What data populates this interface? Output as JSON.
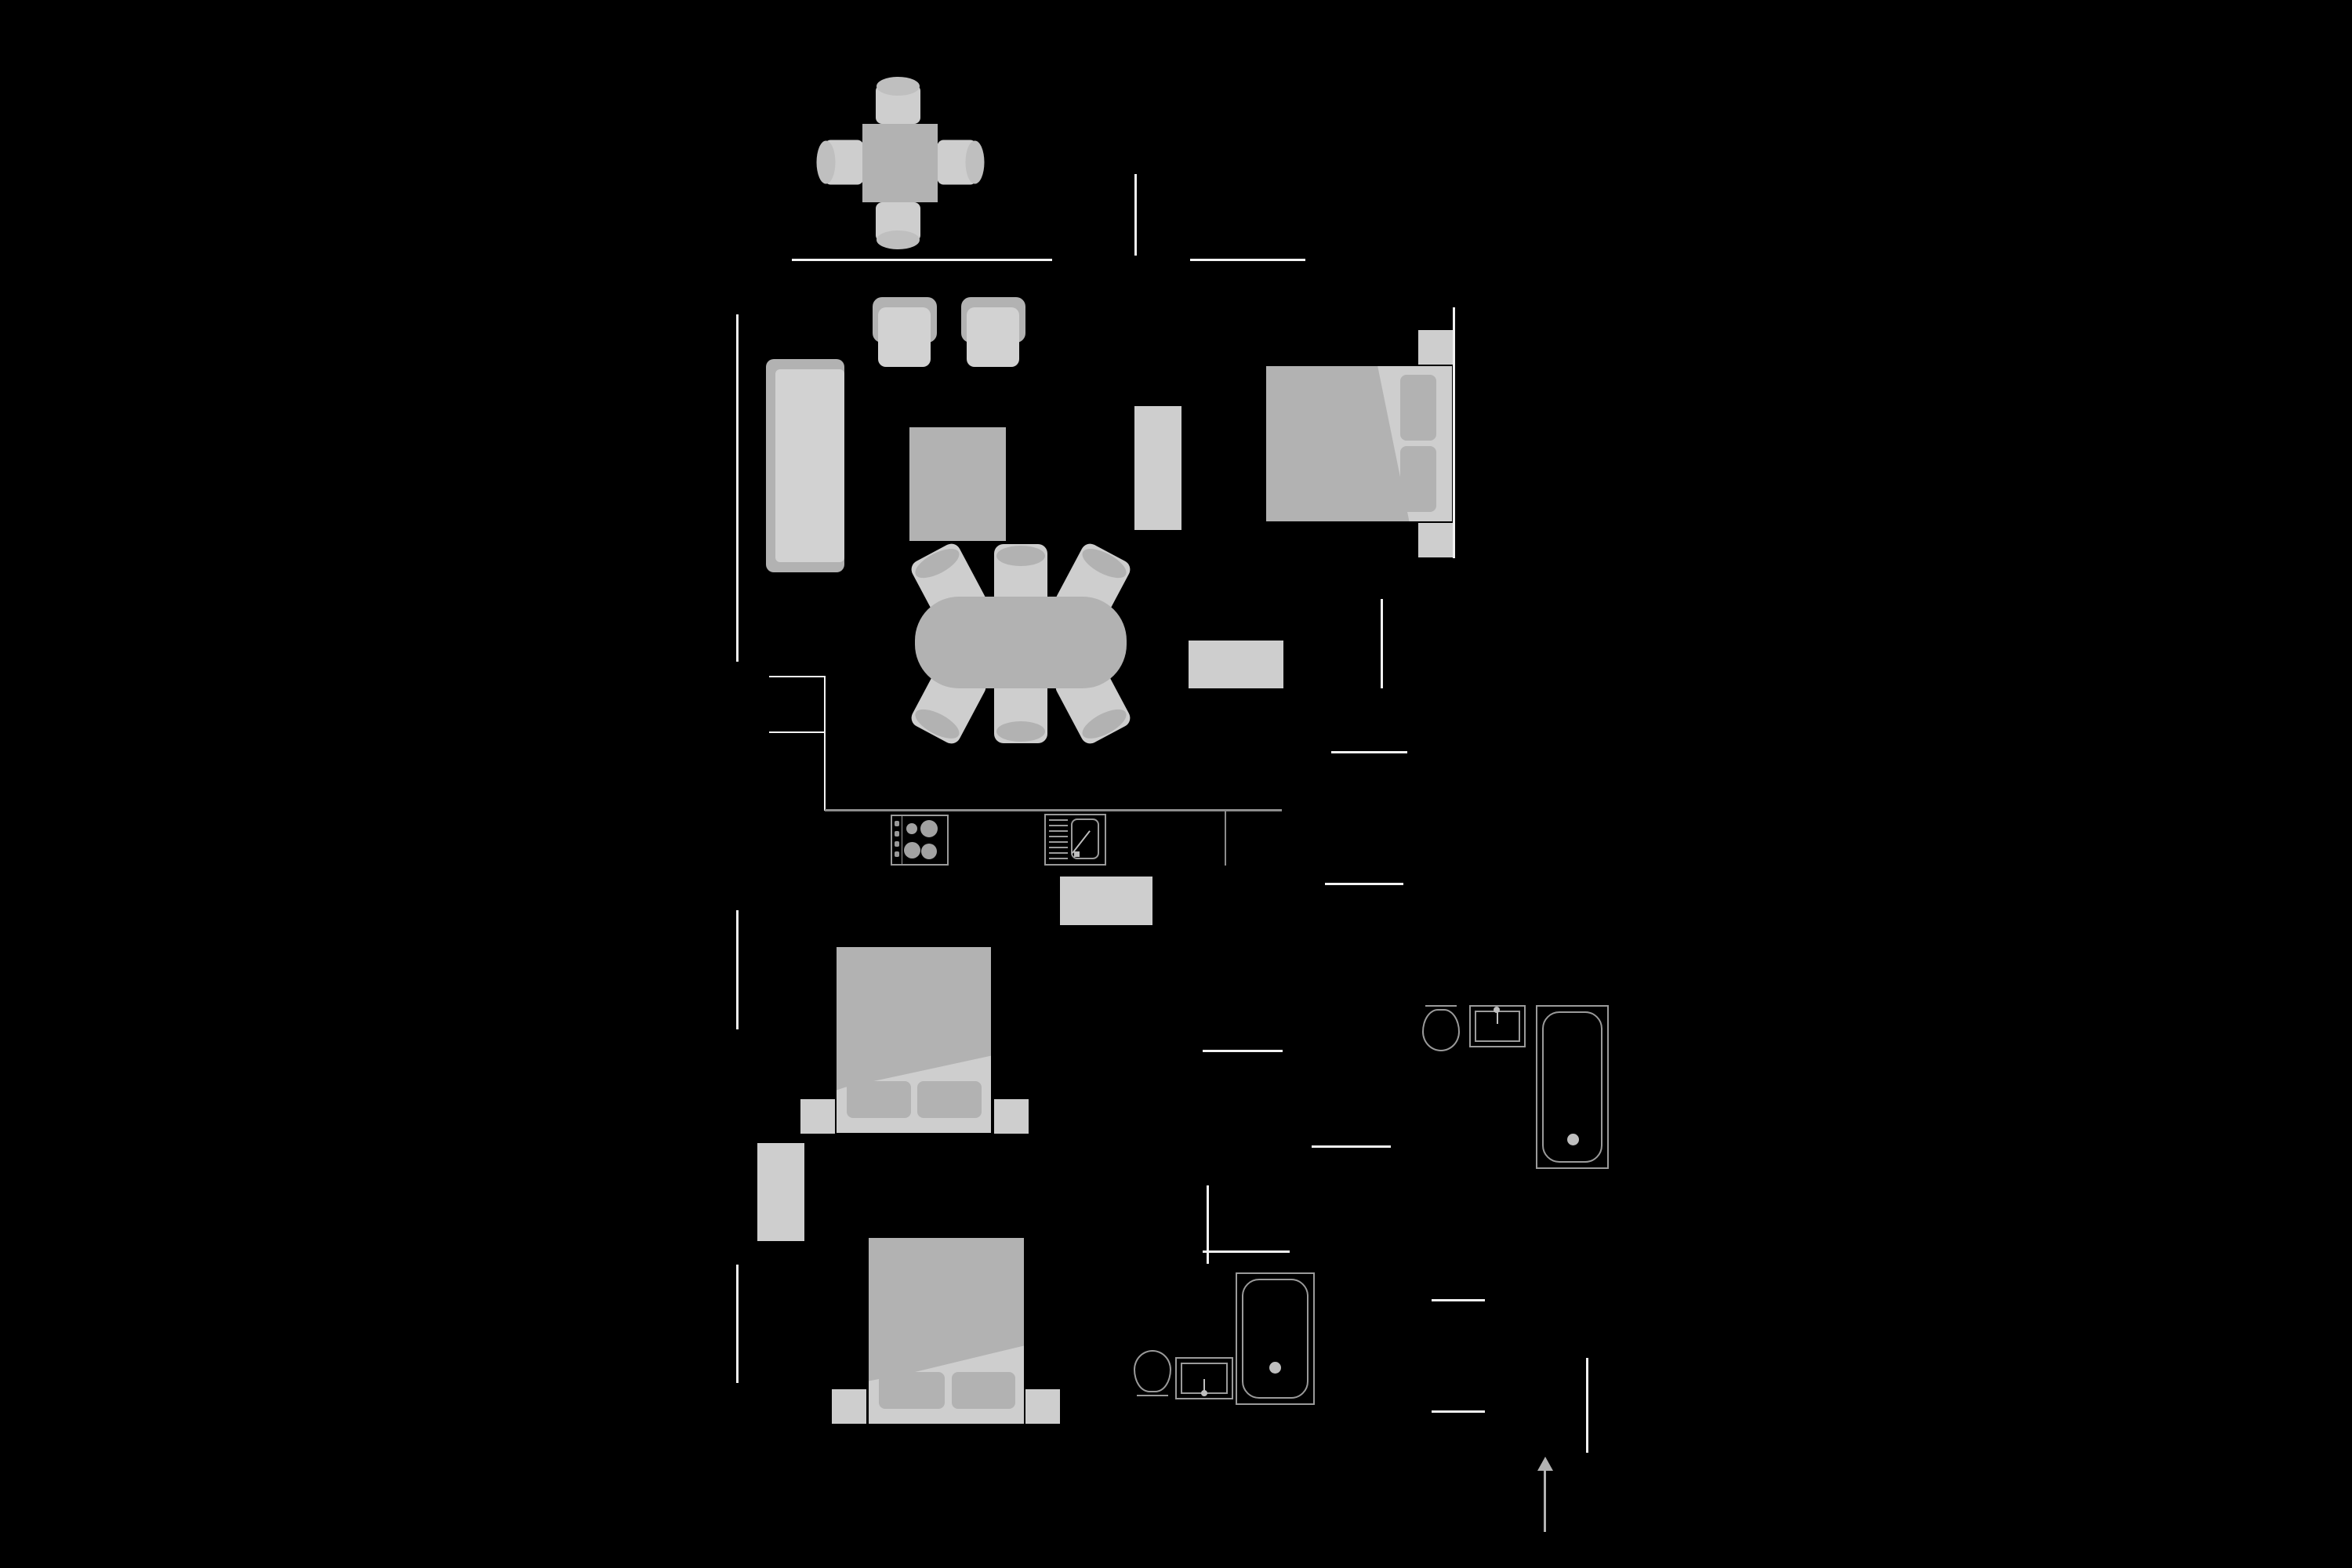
{
  "colors": {
    "background": "#000000",
    "wall": "#f2f2f2",
    "line": "#8c8c8c",
    "outline": "#9a9a9a",
    "flight": "#cecece",
    "fmid": "#b2b2b2",
    "cap": "#bfbfbf",
    "seat": "#d2d2d2",
    "burner": "#a2a2a2",
    "arrow": "#b2b2b2"
  },
  "plan": {
    "type": "apartment-floor-plan",
    "areas": [
      {
        "name": "balcony",
        "furniture": [
          {
            "icon": "bistro-table",
            "count": 1
          },
          {
            "icon": "stool",
            "count": 4
          }
        ]
      },
      {
        "name": "living-room",
        "furniture": [
          {
            "icon": "sofa",
            "count": 1
          },
          {
            "icon": "armchair",
            "count": 2
          },
          {
            "icon": "coffee-table",
            "count": 1
          },
          {
            "icon": "tv-cabinet",
            "count": 1
          }
        ]
      },
      {
        "name": "dining-area",
        "furniture": [
          {
            "icon": "oval-dining-table",
            "count": 1
          },
          {
            "icon": "dining-chair",
            "count": 6
          },
          {
            "icon": "sideboard",
            "count": 1
          }
        ]
      },
      {
        "name": "kitchen",
        "furniture": [
          {
            "icon": "cooktop",
            "count": 1
          },
          {
            "icon": "kitchen-sink",
            "count": 1
          },
          {
            "icon": "kitchen-island",
            "count": 1
          }
        ]
      },
      {
        "name": "bedroom-1",
        "furniture": [
          {
            "icon": "double-bed",
            "count": 1
          },
          {
            "icon": "nightstand",
            "count": 2
          }
        ]
      },
      {
        "name": "bedroom-2",
        "furniture": [
          {
            "icon": "double-bed",
            "count": 1
          },
          {
            "icon": "nightstand",
            "count": 2
          },
          {
            "icon": "wardrobe",
            "count": 1
          }
        ]
      },
      {
        "name": "bedroom-3",
        "furniture": [
          {
            "icon": "double-bed",
            "count": 1
          },
          {
            "icon": "nightstand",
            "count": 2
          }
        ]
      },
      {
        "name": "bathroom-1",
        "furniture": [
          {
            "icon": "toilet",
            "count": 1
          },
          {
            "icon": "washbasin",
            "count": 1
          },
          {
            "icon": "bathtub",
            "count": 1
          }
        ]
      },
      {
        "name": "bathroom-2",
        "furniture": [
          {
            "icon": "toilet",
            "count": 1
          },
          {
            "icon": "washbasin",
            "count": 1
          },
          {
            "icon": "shower-tub",
            "count": 1
          }
        ]
      }
    ],
    "annotations": [
      {
        "icon": "north-arrow",
        "count": 1
      }
    ]
  }
}
